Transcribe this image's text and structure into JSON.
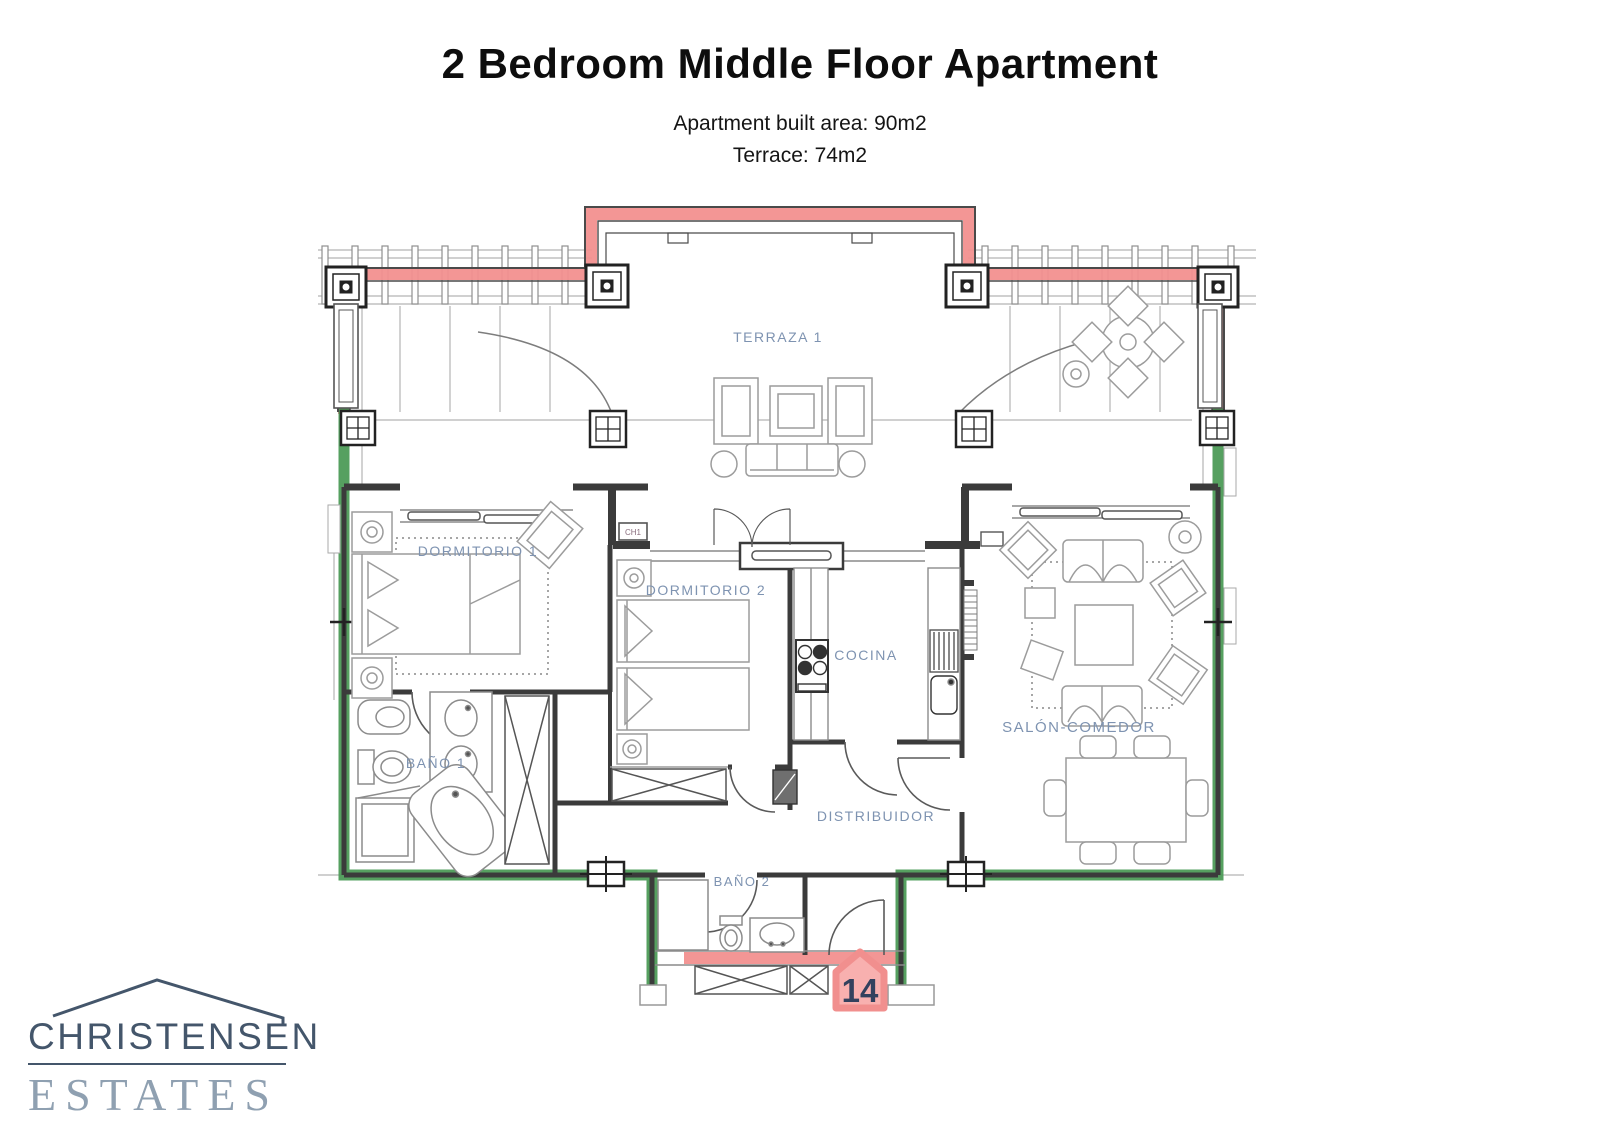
{
  "header": {
    "title": "2 Bedroom Middle Floor Apartment",
    "subtitle_line1": "Apartment built area: 90m2",
    "subtitle_line2": "Terrace: 74m2"
  },
  "plan": {
    "rooms": {
      "terraza": {
        "label": "TERRAZA 1"
      },
      "dormitorio1": {
        "label": "DORMITORIO 1"
      },
      "dormitorio2": {
        "label": "DORMITORIO 2"
      },
      "cocina": {
        "label": "COCINA"
      },
      "salon": {
        "label": "SALÓN-COMEDOR"
      },
      "bano1": {
        "label": "BAÑO 1"
      },
      "bano2": {
        "label": "BAÑO 2"
      },
      "distribuidor": {
        "label": "DISTRIBUIDOR"
      }
    },
    "annotations": {
      "wall_box_label": "CH1"
    },
    "unit_number": "14",
    "colors": {
      "terrace_wall_highlight": "#f2908f",
      "party_wall_highlight": "#4d9b57",
      "room_label": "#7e93b1",
      "unit_number_text": "#33415e",
      "wall_line": "#3b3b3b",
      "furniture_line": "#9c9c9c"
    }
  },
  "logo": {
    "name": "CHRISTENSEN",
    "subname": "ESTATES"
  }
}
